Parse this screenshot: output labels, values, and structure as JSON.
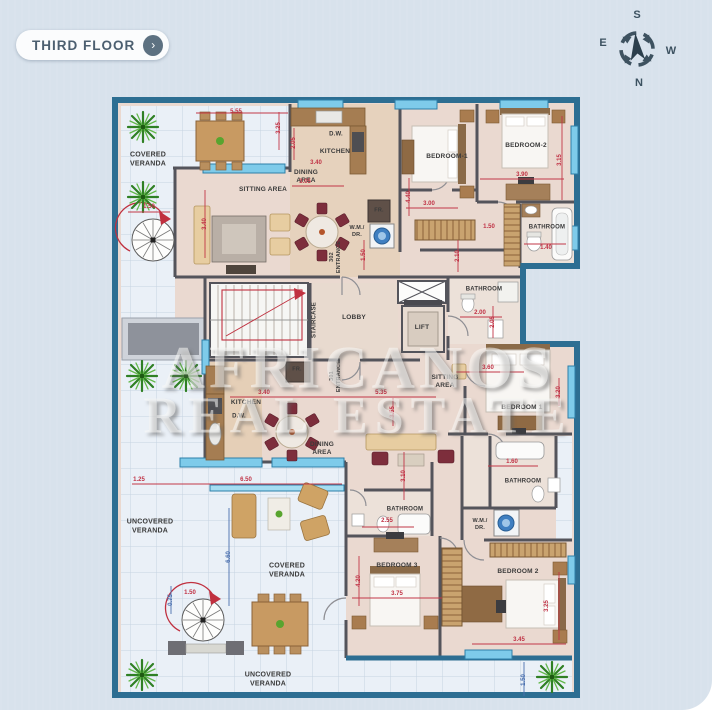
{
  "header": {
    "floor_button": {
      "label": "THIRD FLOOR",
      "arrow_icon": "›"
    }
  },
  "compass": {
    "top": "S",
    "left": "E",
    "right": "W",
    "bottom": "N"
  },
  "watermark": {
    "line1": "AFRICANOS",
    "line2": "REAL ESTATE"
  },
  "colors": {
    "background": "#d8e2ec",
    "exterior_wall": "#2d6e92",
    "interior_wall": "#54545b",
    "window": "#7ecbea",
    "dim_red": "#c23747",
    "dim_blue": "#4a6fae",
    "floor": "#ead9d0",
    "veranda": "#eaf0f7",
    "plant": "#2f8024",
    "chair_red": "#7d2e3c"
  },
  "plan": {
    "room_labels": [
      {
        "lines": [
          "COVERED",
          "VERANDA"
        ],
        "x": 148,
        "y": 160,
        "s": 7
      },
      {
        "lines": [
          "SITTING AREA"
        ],
        "x": 263,
        "y": 190
      },
      {
        "lines": [
          "D.W."
        ],
        "x": 336,
        "y": 135,
        "s": 6
      },
      {
        "lines": [
          "KITCHEN"
        ],
        "x": 335,
        "y": 152
      },
      {
        "lines": [
          "DINING",
          "AREA"
        ],
        "x": 306,
        "y": 177
      },
      {
        "lines": [
          "302",
          "ENTRANCE"
        ],
        "x": 336,
        "y": 257,
        "v": true,
        "s": 5.5
      },
      {
        "lines": [
          "FR."
        ],
        "x": 379,
        "y": 211,
        "s": 5.5
      },
      {
        "lines": [
          "W.M./",
          "DR."
        ],
        "x": 357,
        "y": 232,
        "s": 5.5
      },
      {
        "lines": [
          "BEDROOM-1"
        ],
        "x": 447,
        "y": 157
      },
      {
        "lines": [
          "BEDROOM-2"
        ],
        "x": 526,
        "y": 146
      },
      {
        "lines": [
          "BATHROOM"
        ],
        "x": 547,
        "y": 228,
        "s": 6
      },
      {
        "lines": [
          "BATHROOM"
        ],
        "x": 484,
        "y": 290,
        "s": 6
      },
      {
        "lines": [
          "STAIRCASE"
        ],
        "x": 315,
        "y": 320,
        "v": true,
        "s": 6
      },
      {
        "lines": [
          "LOBBY"
        ],
        "x": 354,
        "y": 318
      },
      {
        "lines": [
          "LIFT"
        ],
        "x": 422,
        "y": 328
      },
      {
        "lines": [
          "FR."
        ],
        "x": 297,
        "y": 370,
        "s": 5.5
      },
      {
        "lines": [
          "301",
          "ENTRANCE"
        ],
        "x": 336,
        "y": 376,
        "v": true,
        "s": 5.5
      },
      {
        "lines": [
          "SITTING",
          "AREA"
        ],
        "x": 445,
        "y": 382
      },
      {
        "lines": [
          "KITCHEN"
        ],
        "x": 246,
        "y": 403
      },
      {
        "lines": [
          "D.W."
        ],
        "x": 239,
        "y": 417,
        "s": 6
      },
      {
        "lines": [
          "DINING",
          "AREA"
        ],
        "x": 322,
        "y": 449
      },
      {
        "lines": [
          "BATHROOM"
        ],
        "x": 405,
        "y": 510,
        "s": 6
      },
      {
        "lines": [
          "BATHROOM"
        ],
        "x": 523,
        "y": 482,
        "s": 6
      },
      {
        "lines": [
          "W.M./",
          "DR."
        ],
        "x": 480,
        "y": 525,
        "s": 5.5
      },
      {
        "lines": [
          "BEDROOM 3"
        ],
        "x": 397,
        "y": 566
      },
      {
        "lines": [
          "BEDROOM 2"
        ],
        "x": 518,
        "y": 572
      },
      {
        "lines": [
          "BEDROOM 1"
        ],
        "x": 522,
        "y": 408
      },
      {
        "lines": [
          "UNCOVERED",
          "VERANDA"
        ],
        "x": 150,
        "y": 527,
        "s": 7
      },
      {
        "lines": [
          "COVERED",
          "VERANDA"
        ],
        "x": 287,
        "y": 571,
        "s": 7
      },
      {
        "lines": [
          "UNCOVERED",
          "VERANDA"
        ],
        "x": 268,
        "y": 680,
        "s": 7
      }
    ],
    "dim_labels": [
      {
        "t": "5.55",
        "x": 236,
        "y": 112
      },
      {
        "t": "3.25",
        "x": 279,
        "y": 128,
        "v": true
      },
      {
        "t": "3.05",
        "x": 305,
        "y": 182
      },
      {
        "t": "1.50",
        "x": 149,
        "y": 207
      },
      {
        "t": "3.40",
        "x": 205,
        "y": 224,
        "v": true
      },
      {
        "t": "3.40",
        "x": 316,
        "y": 163
      },
      {
        "t": "2.05",
        "x": 294,
        "y": 143,
        "v": true
      },
      {
        "t": "4.40",
        "x": 409,
        "y": 197,
        "v": true
      },
      {
        "t": "3.00",
        "x": 429,
        "y": 204
      },
      {
        "t": "3.90",
        "x": 522,
        "y": 175
      },
      {
        "t": "3.15",
        "x": 560,
        "y": 160,
        "v": true
      },
      {
        "t": "1.40",
        "x": 546,
        "y": 248
      },
      {
        "t": "1.50",
        "x": 489,
        "y": 227
      },
      {
        "t": "2.10",
        "x": 458,
        "y": 256,
        "v": true
      },
      {
        "t": "2.00",
        "x": 480,
        "y": 313
      },
      {
        "t": "2.05",
        "x": 493,
        "y": 322,
        "v": true
      },
      {
        "t": "1.50",
        "x": 364,
        "y": 255,
        "v": true
      },
      {
        "t": "3.40",
        "x": 264,
        "y": 393
      },
      {
        "t": "5.35",
        "x": 381,
        "y": 393
      },
      {
        "t": "3.55",
        "x": 393,
        "y": 412,
        "v": true
      },
      {
        "t": "3.10",
        "x": 404,
        "y": 476,
        "v": true
      },
      {
        "t": "1.25",
        "x": 139,
        "y": 480
      },
      {
        "t": "6.50",
        "x": 246,
        "y": 480
      },
      {
        "t": "6.60",
        "x": 229,
        "y": 557,
        "v": true,
        "b": true
      },
      {
        "t": "1.50",
        "x": 190,
        "y": 593
      },
      {
        "t": "0.75",
        "x": 171,
        "y": 600,
        "v": true,
        "b": true
      },
      {
        "t": "3.60",
        "x": 488,
        "y": 368
      },
      {
        "t": "3.20",
        "x": 559,
        "y": 392,
        "v": true
      },
      {
        "t": "1.60",
        "x": 512,
        "y": 462
      },
      {
        "t": "2.55",
        "x": 387,
        "y": 521
      },
      {
        "t": "3.75",
        "x": 397,
        "y": 594
      },
      {
        "t": "4.20",
        "x": 359,
        "y": 581,
        "v": true
      },
      {
        "t": "3.25",
        "x": 547,
        "y": 606,
        "v": true
      },
      {
        "t": "3.45",
        "x": 519,
        "y": 640
      },
      {
        "t": "1.50",
        "x": 524,
        "y": 680,
        "v": true,
        "b": true
      }
    ]
  }
}
